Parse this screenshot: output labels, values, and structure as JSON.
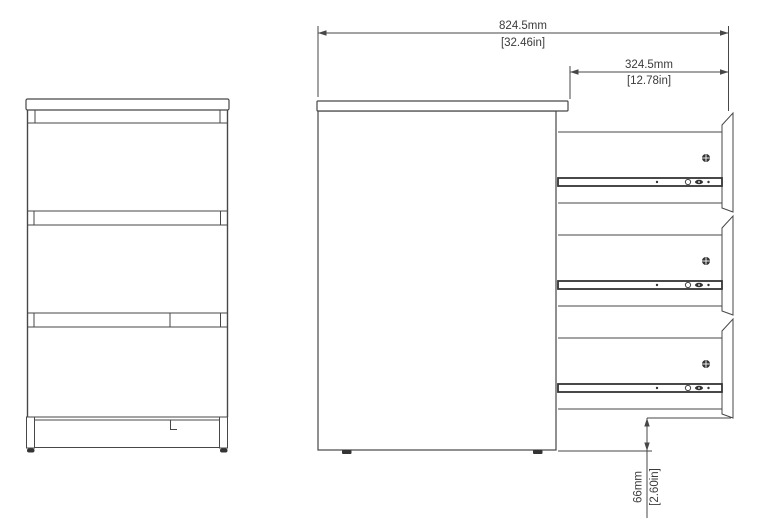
{
  "colors": {
    "background": "#ffffff",
    "line": "#474747",
    "dark_fill": "#343434",
    "text": "#3b3b3b"
  },
  "dimensions": {
    "overall_width": {
      "metric": "824.5mm",
      "imperial": "[32.46in]"
    },
    "drawer_extension": {
      "metric": "324.5mm",
      "imperial": "[12.78in]"
    },
    "floor_clearance": {
      "metric": "66mm",
      "imperial": "[2.60in]"
    }
  }
}
